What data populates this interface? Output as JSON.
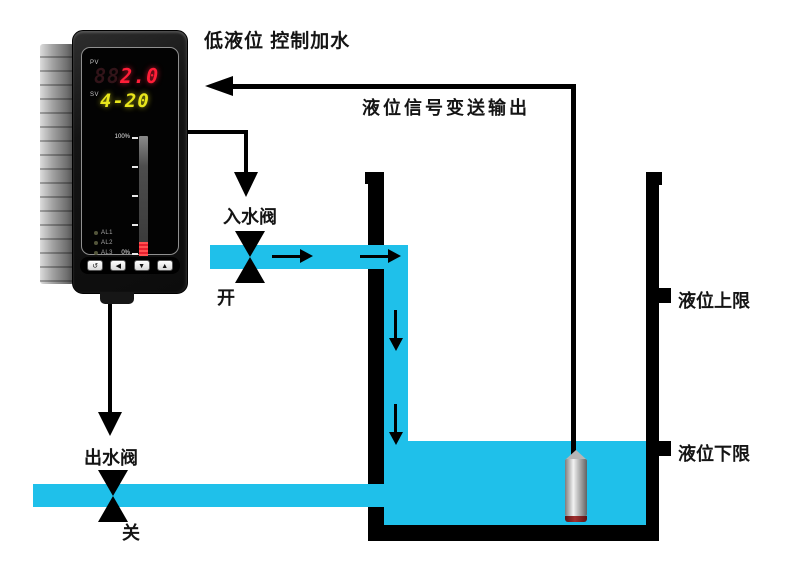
{
  "title": "低液位 控制加水",
  "signal_path": {
    "label": "液位信号变送输出"
  },
  "inlet_valve": {
    "label": "入水阀",
    "state": "开"
  },
  "outlet_valve": {
    "label": "出水阀",
    "state": "关"
  },
  "tank": {
    "upper_limit_label": "液位上限",
    "lower_limit_label": "液位下限"
  },
  "meter": {
    "pv_label": "PV",
    "pv_ghost": "88",
    "pv_value": "2.0",
    "sv_label": "SV",
    "sv_value": "4-20",
    "bar": {
      "max_label": "100%",
      "min_label": "0%",
      "fill_percent": 12
    },
    "alarm_labels": [
      "AL1",
      "AL2",
      "AL3",
      "AL4"
    ],
    "keys": [
      "↺",
      "◀",
      "▼",
      "▲"
    ]
  },
  "colors": {
    "water": "#1FC0EA",
    "line": "#000000",
    "pv_red": "#FF1E38",
    "sv_yellow": "#E8E61C",
    "bar_red": "#E81F2E"
  }
}
